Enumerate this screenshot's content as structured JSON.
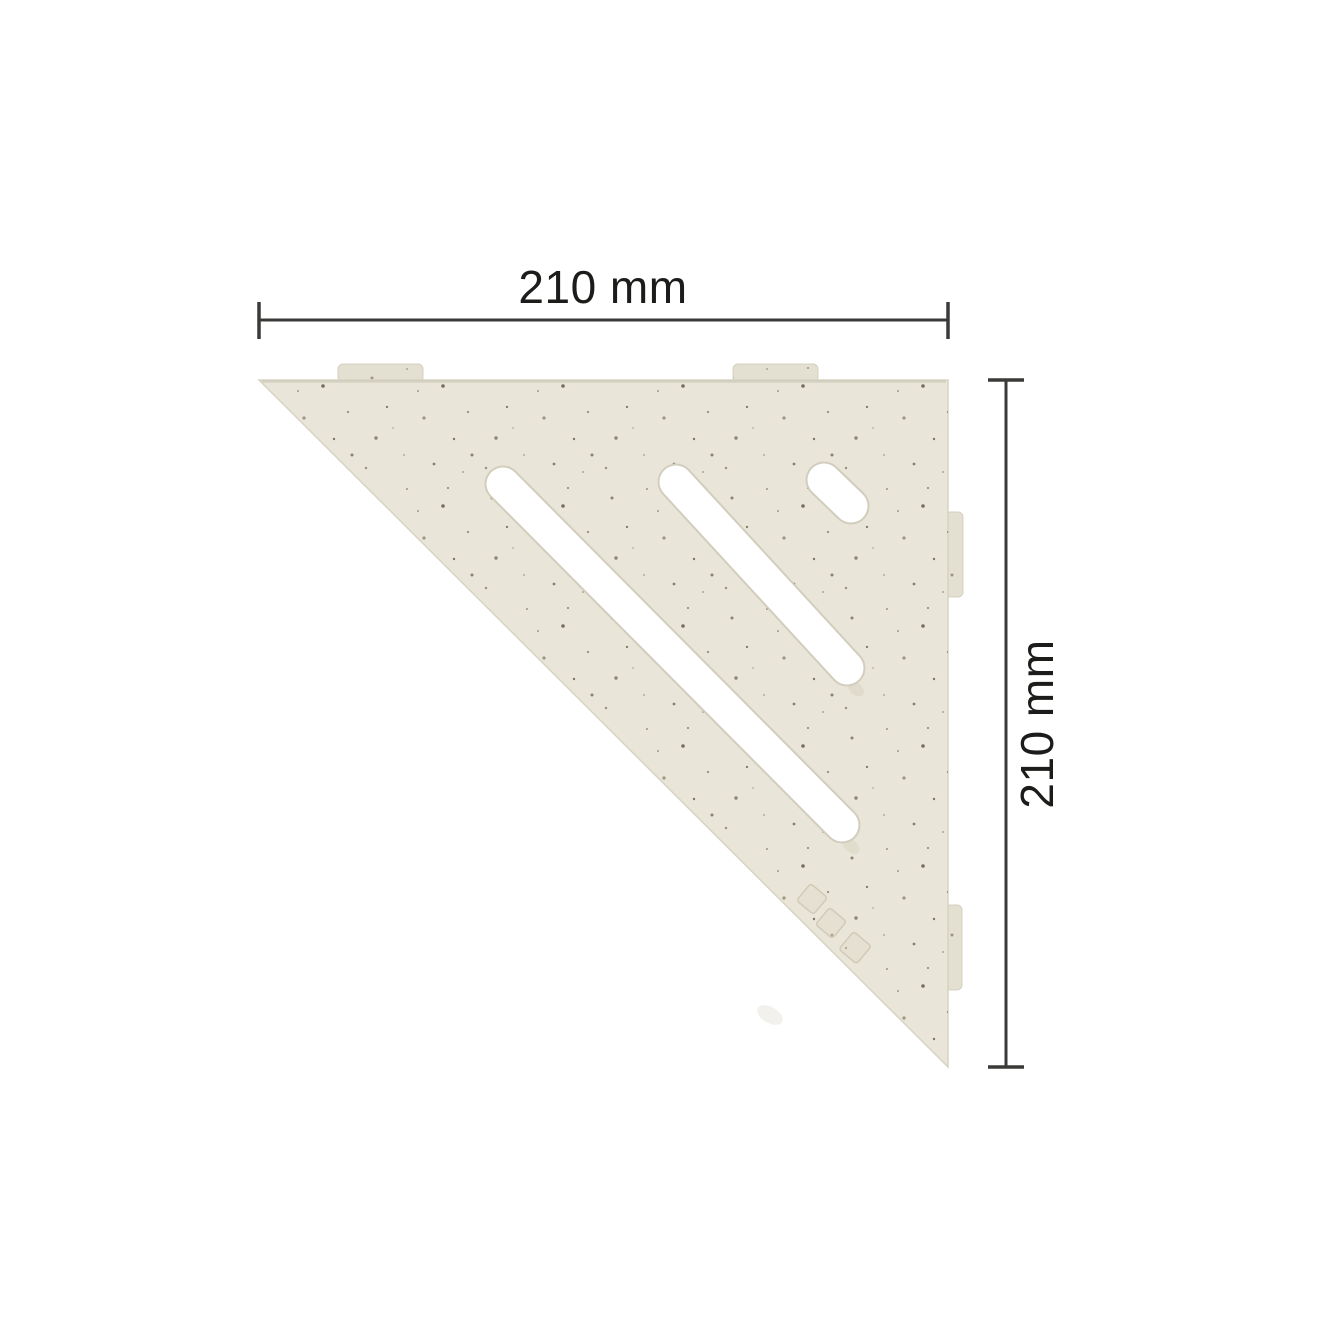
{
  "diagram": {
    "width_dimension": {
      "label": "210 mm"
    },
    "height_dimension": {
      "label": "210 mm"
    },
    "colors": {
      "background": "#ffffff",
      "shelf_face": "#e9e5d8",
      "shelf_edge": "#d8d3c3",
      "tab_face": "#e3dfd1",
      "tab_edge": "#d5d0c0",
      "slot_rim": "#d2cdbd",
      "slot_fill": "#ffffff",
      "speckle_dark": "#7c7565",
      "speckle_mid": "#948d7a",
      "speckle_light": "#b3ac99",
      "emboss": "#bdb69f",
      "dimension_line": "#3a3a38",
      "label_text": "#1c1c1a"
    }
  }
}
